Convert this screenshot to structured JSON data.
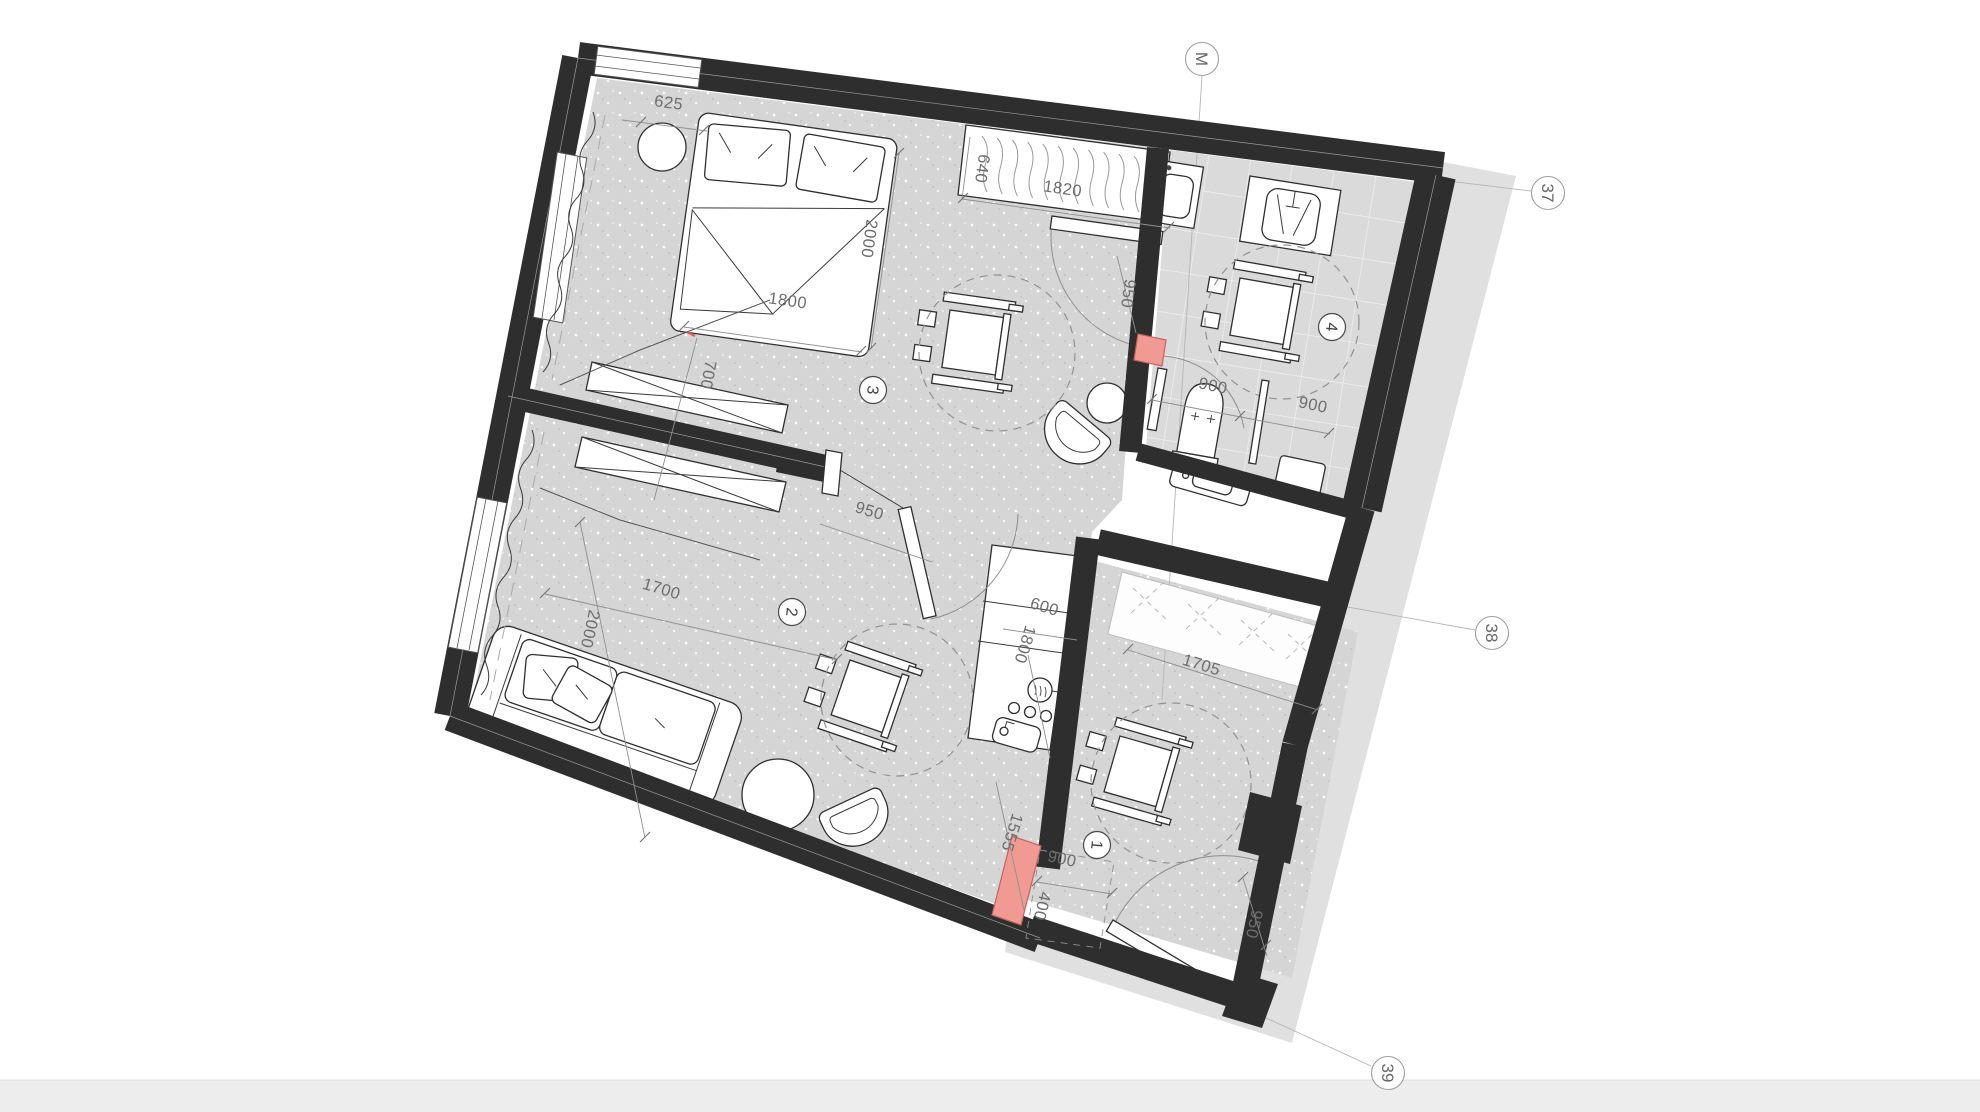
{
  "plan": {
    "grid_markers": [
      {
        "id": "axis-m",
        "label": "M"
      },
      {
        "id": "axis-37",
        "label": "37"
      },
      {
        "id": "axis-38",
        "label": "38"
      },
      {
        "id": "axis-39",
        "label": "39"
      }
    ],
    "rooms": [
      {
        "id": "entry-hall",
        "number": "1"
      },
      {
        "id": "living-room",
        "number": "2"
      },
      {
        "id": "bedroom",
        "number": "3"
      },
      {
        "id": "bathroom",
        "number": "4"
      }
    ],
    "dimensions": [
      {
        "id": "bedroom-wall-offset",
        "label": "625"
      },
      {
        "id": "wardrobe-depth",
        "label": "640"
      },
      {
        "id": "wardrobe-width",
        "label": "1820"
      },
      {
        "id": "bed-width",
        "label": "1800"
      },
      {
        "id": "bed-length",
        "label": "2000"
      },
      {
        "id": "bed-side-clearance",
        "label": "700"
      },
      {
        "id": "corridor-width",
        "label": "950"
      },
      {
        "id": "bedroom-door-width",
        "label": "950"
      },
      {
        "id": "living-clearance-width",
        "label": "1700"
      },
      {
        "id": "living-clearance-depth",
        "label": "2000"
      },
      {
        "id": "kitchen-depth",
        "label": "600"
      },
      {
        "id": "kitchen-length",
        "label": "1800"
      },
      {
        "id": "bathroom-clearance-left",
        "label": "900"
      },
      {
        "id": "bathroom-clearance-right",
        "label": "900"
      },
      {
        "id": "entry-closet-width",
        "label": "1705"
      },
      {
        "id": "entry-wall-length",
        "label": "1555"
      },
      {
        "id": "entry-clearance",
        "label": "900"
      },
      {
        "id": "entry-door-offset",
        "label": "400"
      },
      {
        "id": "entry-door-width",
        "label": "950"
      }
    ],
    "colors": {
      "wall": "#2e2e2e",
      "floor": "#d5d5d5",
      "tile_floor": "#dadada",
      "shadow": "#e0e0e0",
      "door_highlight": "#f19a94"
    }
  }
}
